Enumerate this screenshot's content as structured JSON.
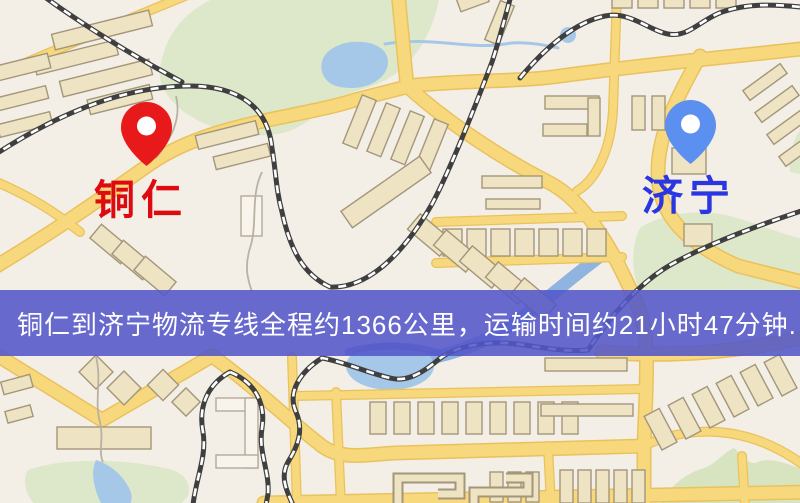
{
  "map": {
    "markers": [
      {
        "name": "铜仁",
        "pin": "red"
      },
      {
        "name": "济宁",
        "pin": "blue"
      }
    ]
  },
  "banner": {
    "text": "铜仁到济宁物流专线全程约1366公里，运输时间约21小时47分钟."
  },
  "colors": {
    "map_bg": "#f4efe6",
    "park_green": "#dde8ca",
    "hill_green": "#d7e4bf",
    "water_blue": "#a6c8e8",
    "river_blue": "#8fb4e0",
    "deep_blue": "#6d8fd4",
    "road_fill": "#f7d87c",
    "road_edge": "#e9c25d",
    "building_fill": "#eee3c2",
    "building_stroke": "#a3967b",
    "building_white": "#f8f4ec",
    "railway_dark": "#3f3f3f",
    "railway_light": "#ffffff",
    "stream_grey": "#b8b1a4",
    "banner_bg": "rgba(83,86,202,0.88)",
    "banner_text": "#ffffff",
    "pin_red": "#e8191b",
    "pin_blue": "#5b8ff0",
    "pin_hole": "#ffffff",
    "label_red": "#dd0a10",
    "label_blue": "#2936e2"
  }
}
